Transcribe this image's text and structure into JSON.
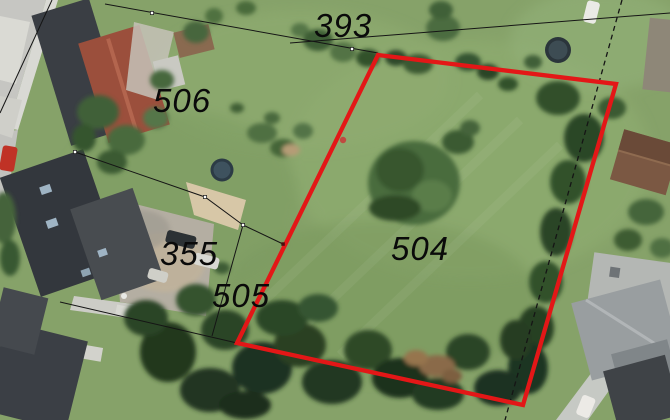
{
  "parcels": [
    {
      "id": "393"
    },
    {
      "id": "506"
    },
    {
      "id": "355"
    },
    {
      "id": "505"
    },
    {
      "id": "504"
    }
  ],
  "highlight": {
    "parcel_id": "504",
    "color": "#e31717",
    "points": "378,55 616,84 523,405 237,343"
  },
  "boundary_color": "#151515",
  "label_color": "#0a0a0a"
}
